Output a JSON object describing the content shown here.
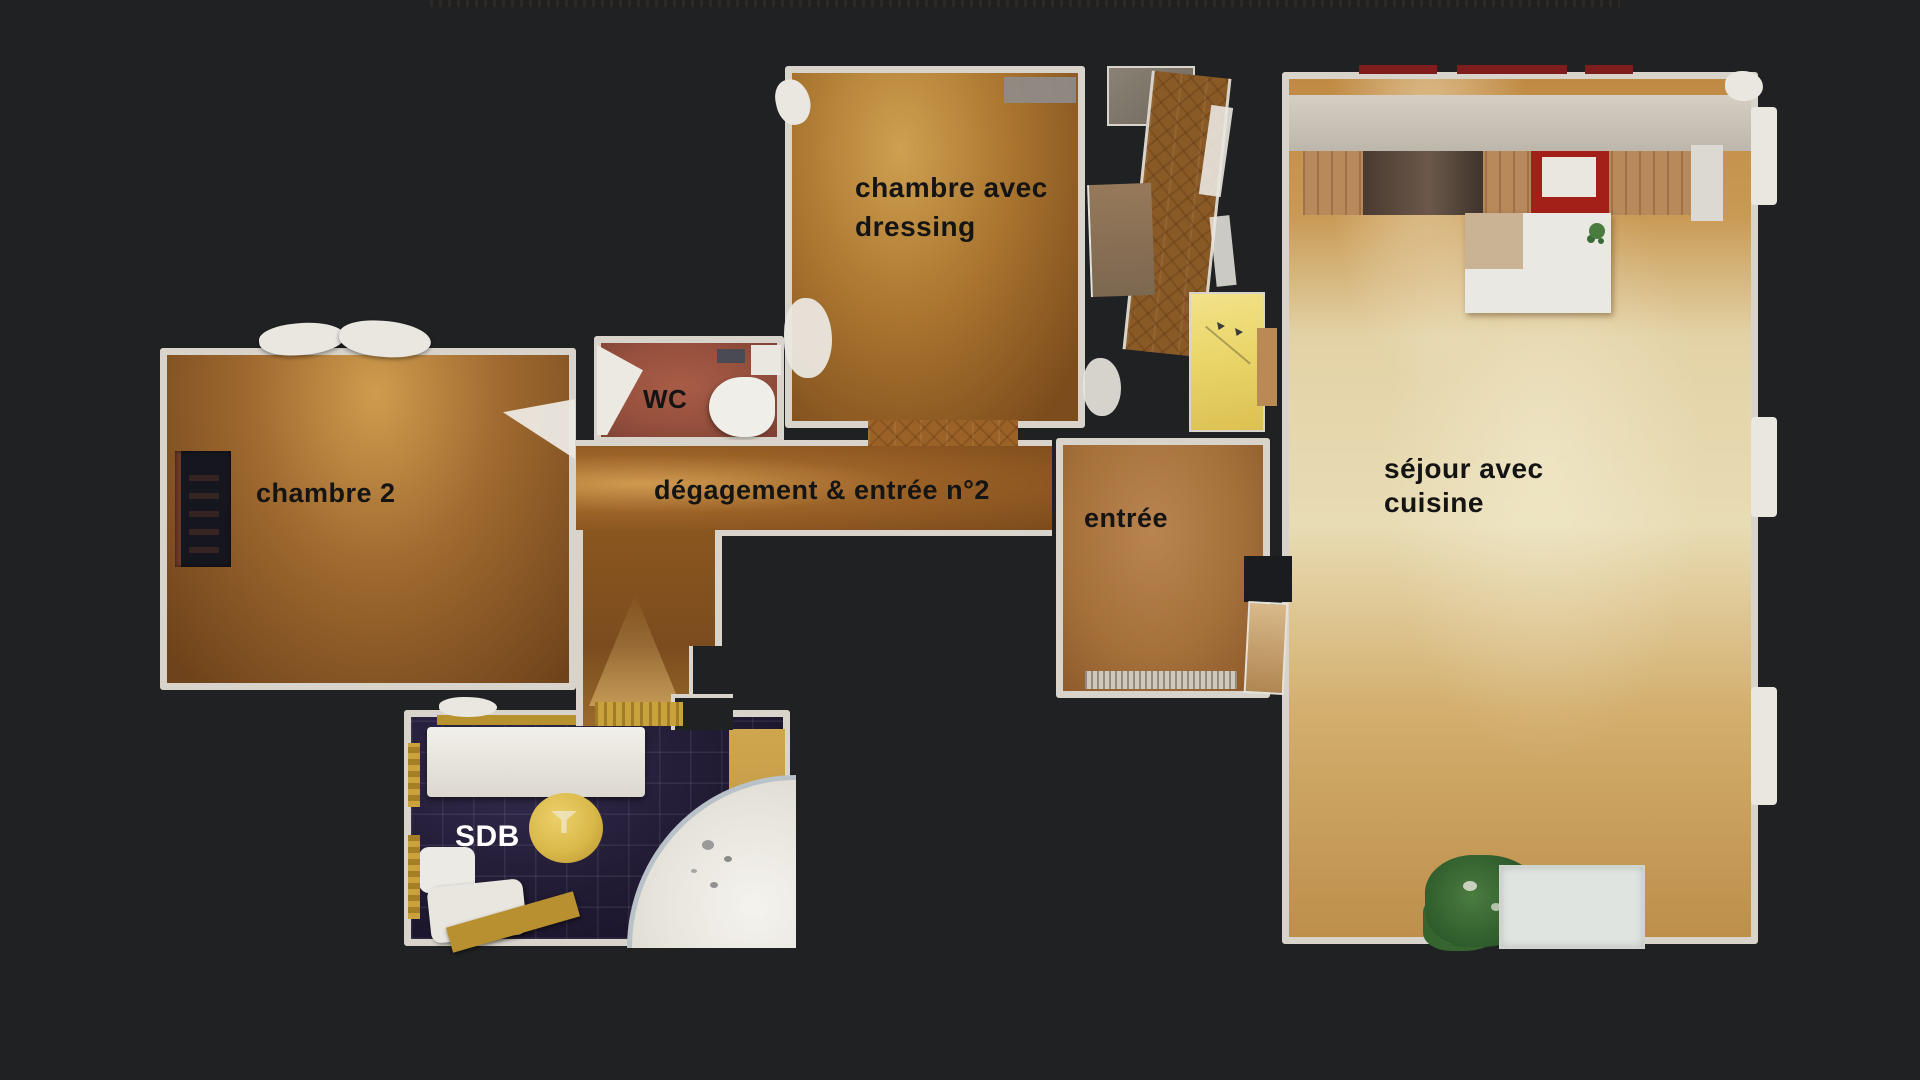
{
  "scene": {
    "type": "apartment-floorplan-3d-scan-topdown",
    "background_color": "#1f2123",
    "wall_color": "#d8d4cb",
    "label_color": "#141414"
  },
  "rooms": {
    "chambre_dressing": {
      "label": "chambre avec dressing",
      "label_line1": "chambre avec",
      "label_line2": "dressing",
      "floor_type": "herringbone-parquet",
      "floor_color": "#a9742f"
    },
    "wc": {
      "label": "WC",
      "floor_type": "terracotta-tile",
      "floor_color": "#96503d"
    },
    "chambre2": {
      "label": "chambre 2",
      "floor_type": "herringbone-parquet",
      "floor_color": "#a06a30"
    },
    "degagement": {
      "label": "dégagement & entrée n°2",
      "floor_type": "plank-wood",
      "floor_color": "#9b6227"
    },
    "entree": {
      "label": "entrée",
      "floor_type": "herringbone-parquet",
      "floor_color": "#a5703a"
    },
    "sejour": {
      "label": "séjour avec cuisine",
      "label_line1": "séjour avec",
      "label_line2": "cuisine",
      "floor_type": "herringbone-parquet-light",
      "floor_color": "#d9c08c"
    },
    "sdb": {
      "label": "SDB",
      "label_color": "#ffffff",
      "floor_type": "dark-navy-tile",
      "floor_color": "#201a33"
    }
  },
  "palette": {
    "accent_yellow_floor": "#ead669",
    "stool_gold": "#d9b94a",
    "counter_red": "#a32019",
    "backsplash_red": "#7e1d1c",
    "kitchen_wall_gray": "#ccc6ba",
    "tub_white": "#eceae3",
    "tub_rim_blue": "#b9c2c9",
    "plant_green": "#3a6b35",
    "mat_white": "#dfe4e0",
    "gold_trim": "#c9a23c"
  }
}
